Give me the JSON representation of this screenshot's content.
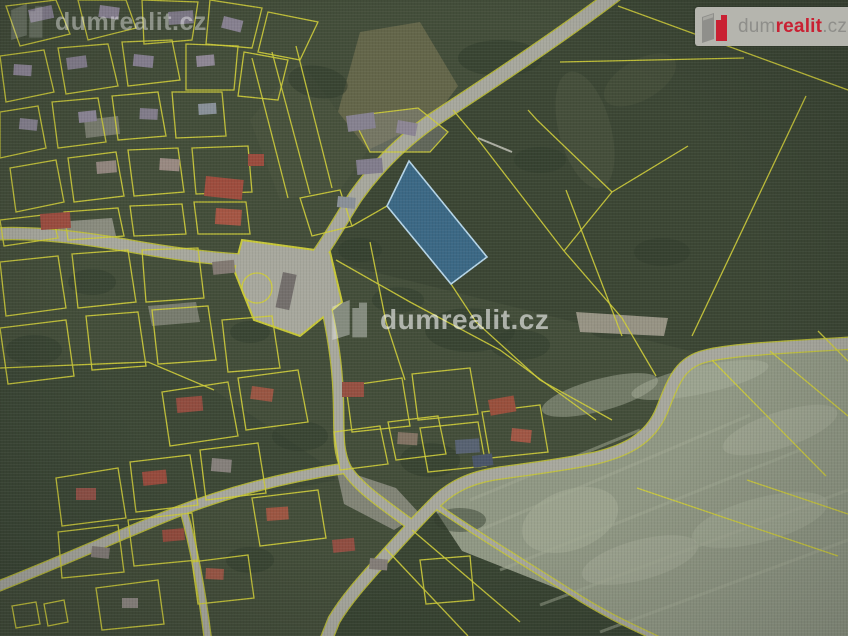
{
  "watermarks": {
    "top_left": "dumrealit.cz",
    "center": "dumrealit.cz"
  },
  "logo": {
    "part1": "dum",
    "part2": "realit",
    "part3": ".cz"
  },
  "map": {
    "base": "#47523c",
    "colors": {
      "parcel_line": "#dedc3c",
      "road_fill": "#b3b3a7",
      "road_edge": "#d6d63a",
      "veg": "#333f2d",
      "blotch": "#b8bfa8",
      "highlight_fill": "#3f8ed6",
      "highlight_stroke": "#c4e6fa"
    },
    "fields": [
      {
        "n": "field-right-dark",
        "p": "616,0 848,0 848,346 714,357 318,258 330,238 356,196 380,166 404,142 432,122 492,82 562,38",
        "f": "#3f4a36",
        "o": 1
      },
      {
        "n": "field-bottomright-light",
        "p": "432,505 470,480 524,471 572,463 616,452 650,435 668,408 679,374 706,357 780,350 848,343 848,636 654,636 558,589 462,551",
        "f": "#9aa28c",
        "o": 1
      },
      {
        "n": "field-tan",
        "p": "338,112 360,32 420,22 458,86 434,118 368,150",
        "f": "#6e6f4f",
        "o": 0.9
      },
      {
        "n": "field-bottom-strips",
        "p": "330,622 432,507 462,551 558,589 652,636 326,636",
        "f": "#3c4834",
        "o": 1
      },
      {
        "n": "field-topcenter",
        "p": "300,60 338,112 368,150 340,190 280,200 250,120",
        "f": "#4d5840",
        "o": 0.8
      },
      {
        "n": "field-bottomleft-dark",
        "p": "0,366 148,362 214,390 330,468 336,480 176,512 0,588",
        "f": "#404c38",
        "o": 1
      }
    ],
    "ellipses": [
      {
        "n": "field-sheen",
        "c": [
          585,
          130,
          26,
          60
        ],
        "f": "#59644a",
        "o": 0.38,
        "r": -15
      },
      {
        "n": "field-sheen",
        "c": [
          640,
          80,
          40,
          20
        ],
        "f": "#59644a",
        "o": 0.3,
        "r": -30
      },
      {
        "n": "mow-blotch",
        "c": [
          600,
          395,
          60,
          16
        ],
        "f": "#b8bfa8",
        "o": 0.45,
        "r": -15
      },
      {
        "n": "mow-blotch",
        "c": [
          700,
          380,
          70,
          14
        ],
        "f": "#b8bfa8",
        "o": 0.45,
        "r": -12
      },
      {
        "n": "mow-blotch",
        "c": [
          780,
          430,
          60,
          18
        ],
        "f": "#b8bfa8",
        "o": 0.4,
        "r": -18
      },
      {
        "n": "mow-blotch",
        "c": [
          570,
          520,
          50,
          30
        ],
        "f": "#b8bfa8",
        "o": 0.42,
        "r": -20
      },
      {
        "n": "mow-blotch",
        "c": [
          640,
          560,
          60,
          20
        ],
        "f": "#b8bfa8",
        "o": 0.4,
        "r": -15
      },
      {
        "n": "mow-blotch",
        "c": [
          760,
          520,
          70,
          22
        ],
        "f": "#b8bfa8",
        "o": 0.38,
        "r": -15
      },
      {
        "n": "trees",
        "c": [
          318,
          82,
          30,
          16
        ],
        "f": "#333f2d",
        "o": 0.55,
        "r": 10
      },
      {
        "n": "trees",
        "c": [
          500,
          58,
          42,
          18
        ],
        "f": "#333f2d",
        "o": 0.55,
        "r": 0
      },
      {
        "n": "trees",
        "c": [
          540,
          160,
          26,
          13
        ],
        "f": "#333f2d",
        "o": 0.5,
        "r": 0
      },
      {
        "n": "trees",
        "c": [
          470,
          330,
          45,
          22
        ],
        "f": "#333f2d",
        "o": 0.55,
        "r": 0
      },
      {
        "n": "trees",
        "c": [
          520,
          345,
          30,
          15
        ],
        "f": "#333f2d",
        "o": 0.5,
        "r": 0
      },
      {
        "n": "trees",
        "c": [
          430,
          460,
          30,
          17
        ],
        "f": "#333f2d",
        "o": 0.55,
        "r": 0
      },
      {
        "n": "trees",
        "c": [
          300,
          436,
          28,
          15
        ],
        "f": "#333f2d",
        "o": 0.5,
        "r": 0
      },
      {
        "n": "trees",
        "c": [
          250,
          332,
          20,
          11
        ],
        "f": "#333f2d",
        "o": 0.5,
        "r": 0
      },
      {
        "n": "trees",
        "c": [
          92,
          282,
          24,
          13
        ],
        "f": "#333f2d",
        "o": 0.5,
        "r": 0
      },
      {
        "n": "trees",
        "c": [
          34,
          350,
          28,
          15
        ],
        "f": "#333f2d",
        "o": 0.5,
        "r": 0
      },
      {
        "n": "trees",
        "c": [
          612,
          330,
          22,
          9
        ],
        "f": "#333f2d",
        "o": 0.45,
        "r": 0
      },
      {
        "n": "trees",
        "c": [
          662,
          252,
          28,
          14
        ],
        "f": "#333f2d",
        "o": 0.45,
        "r": 0
      },
      {
        "n": "trees",
        "c": [
          250,
          560,
          24,
          13
        ],
        "f": "#333f2d",
        "o": 0.5,
        "r": 0
      },
      {
        "n": "trees",
        "c": [
          398,
          300,
          26,
          13
        ],
        "f": "#333f2d",
        "o": 0.5,
        "r": 0
      },
      {
        "n": "trees",
        "c": [
          360,
          250,
          22,
          12
        ],
        "f": "#333f2d",
        "o": 0.5,
        "r": 0
      },
      {
        "n": "trees",
        "c": [
          460,
          520,
          26,
          12
        ],
        "f": "#333f2d",
        "o": 0.45,
        "r": 0
      }
    ],
    "stripes": [
      [
        480,
        530,
        750,
        415
      ],
      [
        500,
        570,
        800,
        450
      ],
      [
        540,
        605,
        848,
        490
      ],
      [
        600,
        632,
        848,
        540
      ],
      [
        470,
        500,
        640,
        430
      ]
    ],
    "patches": [
      {
        "n": "courtyard",
        "p": "56,222 112,218 116,236 60,240",
        "f": "#a6a699",
        "o": 0.8
      },
      {
        "n": "courtyard",
        "p": "336,468 396,488 420,514 394,530 344,504",
        "f": "#a6a699",
        "o": 0.7
      },
      {
        "n": "sand-strip",
        "p": "576,312 668,318 664,336 580,332",
        "f": "#b3ab9b",
        "o": 0.85
      },
      {
        "n": "courtyard",
        "p": "84,120 118,116 120,134 86,138",
        "f": "#a6a699",
        "o": 0.6
      },
      {
        "n": "courtyard",
        "p": "148,306 196,302 200,322 152,326",
        "f": "#a6a699",
        "o": 0.6
      },
      {
        "n": "courtyard",
        "p": "352,116 418,108 448,132 430,152 370,152",
        "f": "#8f8f86",
        "o": 0.5
      }
    ],
    "roads": [
      {
        "n": "road-main-ne",
        "d": "M 616,-6 C 558,38 488,84 430,122 C 402,142 376,168 356,196 C 344,214 330,240 318,256",
        "w": 13
      },
      {
        "n": "road-west",
        "d": "M 318,256 C 282,266 208,260 130,246 C 74,236 28,232 -6,234",
        "w": 11
      },
      {
        "n": "road-south",
        "d": "M 316,258 C 324,298 336,342 338,390 C 340,426 336,448 346,468 C 358,488 386,506 410,524",
        "w": 9
      },
      {
        "n": "road-bottomleft",
        "d": "M -6,588 C 60,562 122,534 174,513 C 232,490 292,476 346,468",
        "w": 9
      },
      {
        "n": "road-bottom-curve",
        "d": "M 852,343 C 792,347 734,349 706,356 C 680,362 674,380 662,410 C 650,440 624,451 596,458 C 558,466 520,470 494,474 C 464,479 446,491 432,506 C 418,520 398,542 380,562 C 362,582 346,600 334,620 L 326,640",
        "w": 11
      },
      {
        "n": "road-branch-south",
        "d": "M 184,512 C 194,548 202,592 208,640",
        "w": 6
      },
      {
        "n": "road-field-track",
        "d": "M 436,506 C 470,530 520,560 570,592 C 610,618 640,630 660,640",
        "w": 4
      }
    ],
    "junction": "242,240 330,252 342,302 300,336 254,320 234,270",
    "parcels": [
      "6,6 56,0 70,34 20,46",
      "78,0 126,0 136,28 88,40",
      "142,0 198,2 192,40 144,44",
      "210,0 262,8 252,48 206,44",
      "268,12 318,22 300,60 258,52",
      "0,56 44,50 54,92 6,102",
      "58,48 108,44 118,86 66,94",
      "122,42 172,40 180,80 128,86",
      "186,44 238,46 234,90 186,90",
      "244,52 288,60 278,100 238,96",
      "0,112 38,106 46,148 0,158",
      "52,102 98,98 106,142 58,148",
      "112,96 158,92 166,136 118,140",
      "172,92 222,92 226,136 176,138",
      "10,168 56,160 64,202 16,212",
      "68,158 116,152 124,196 74,202",
      "128,150 178,148 184,192 134,196",
      "192,148 248,146 252,192 196,194",
      "0,220 52,214 58,238 4,246",
      "64,212 118,208 124,236 68,240",
      "130,206 182,204 186,234 134,236",
      "194,202 246,202 250,234 198,234",
      "0,262 58,256 66,308 6,316",
      "72,254 128,250 136,302 78,308",
      "142,250 198,248 204,298 146,302",
      "0,328 66,320 74,376 8,384",
      "86,316 138,312 146,366 92,370",
      "152,310 208,306 216,360 158,364",
      "222,320 272,316 280,368 228,372",
      "162,392 228,382 238,436 170,446",
      "238,378 298,370 308,422 246,430",
      "56,478 118,468 126,518 62,526",
      "130,462 190,455 198,505 136,512",
      "200,450 258,443 266,493 206,500",
      "252,498 318,490 326,538 260,546",
      "58,532 118,525 124,572 62,578",
      "128,520 192,513 198,560 134,566",
      "192,562 248,555 254,598 198,604",
      "12,606 36,602 40,624 16,628",
      "44,604 64,600 68,622 48,626",
      "96,588 158,580 164,624 102,630",
      "346,386 402,378 410,426 352,432",
      "412,374 470,368 478,414 418,420",
      "420,428 478,422 486,466 428,472",
      "482,412 540,405 548,452 490,458",
      "334,432 380,426 388,464 340,470",
      "388,422 438,416 446,454 396,460",
      "300,198 340,190 352,226 312,236",
      "352,116 418,108 448,132 430,152 370,152",
      "420,560 470,556 474,600 426,604"
    ],
    "circle_parcel": {
      "cx": 257,
      "cy": 288,
      "r": 15
    },
    "lines": [
      "252,58 288,198",
      "272,52 310,194",
      "296,46 332,188",
      "352,226 387,206",
      "451,284 476,322 540,380 612,420",
      "370,242 386,322 405,380",
      "336,260 410,302 500,350 596,420",
      "453,110 480,142 564,251",
      "528,110 537,120 612,192",
      "612,192 564,251",
      "612,192 688,146",
      "564,251 622,318 656,376",
      "618,6 848,90",
      "560,62 744,58",
      "566,190 622,336",
      "806,96 692,336",
      "712,360 826,476",
      "770,351 848,416",
      "637,488 838,556",
      "747,480 848,514",
      "0,368 148,362 214,390",
      "385,548 468,636",
      "412,530 520,622",
      "818,331 848,361"
    ],
    "buildings": [
      [
        28,
        10,
        24,
        13,
        -12,
        "#8e8897"
      ],
      [
        100,
        5,
        20,
        12,
        8,
        "#978fa0"
      ],
      [
        168,
        12,
        25,
        13,
        -4,
        "#8a8493"
      ],
      [
        224,
        16,
        20,
        12,
        14,
        "#938c9c"
      ],
      [
        14,
        64,
        18,
        11,
        4,
        "#968e9e"
      ],
      [
        66,
        58,
        20,
        12,
        -8,
        "#8d8695"
      ],
      [
        134,
        54,
        20,
        12,
        6,
        "#90899a"
      ],
      [
        196,
        56,
        18,
        11,
        -5,
        "#99919f"
      ],
      [
        20,
        118,
        18,
        11,
        6,
        "#8f8a98"
      ],
      [
        78,
        112,
        18,
        11,
        -6,
        "#968fa0"
      ],
      [
        140,
        108,
        18,
        11,
        3,
        "#8b8593"
      ],
      [
        198,
        104,
        18,
        11,
        -4,
        "#929aa2"
      ],
      [
        40,
        214,
        30,
        16,
        -4,
        "#a85243"
      ],
      [
        206,
        176,
        38,
        20,
        6,
        "#a85140"
      ],
      [
        216,
        208,
        26,
        16,
        4,
        "#b05b47"
      ],
      [
        248,
        154,
        16,
        12,
        0,
        "#a55040"
      ],
      [
        96,
        162,
        20,
        12,
        -5,
        "#9c8f86"
      ],
      [
        160,
        158,
        20,
        12,
        4,
        "#a39289"
      ],
      [
        283,
        272,
        14,
        36,
        12,
        "#7b7672"
      ],
      [
        212,
        262,
        22,
        13,
        -6,
        "#8b8179"
      ],
      [
        346,
        116,
        28,
        16,
        -8,
        "#8f8a99"
      ],
      [
        398,
        120,
        20,
        13,
        10,
        "#968e9d"
      ],
      [
        356,
        160,
        26,
        15,
        -5,
        "#8a8595"
      ],
      [
        338,
        196,
        18,
        11,
        6,
        "#939aa1"
      ],
      [
        342,
        382,
        22,
        15,
        0,
        "#a05545"
      ],
      [
        488,
        400,
        26,
        16,
        -10,
        "#a3543f"
      ],
      [
        512,
        428,
        20,
        13,
        6,
        "#ab5c48"
      ],
      [
        455,
        440,
        24,
        14,
        -4,
        "#5d6878"
      ],
      [
        472,
        456,
        20,
        12,
        -8,
        "#4e5a6e"
      ],
      [
        176,
        398,
        26,
        15,
        -5,
        "#9b5142"
      ],
      [
        252,
        386,
        22,
        13,
        8,
        "#a35b46"
      ],
      [
        76,
        488,
        20,
        12,
        0,
        "#99564a"
      ],
      [
        142,
        472,
        24,
        14,
        -6,
        "#a25040"
      ],
      [
        212,
        458,
        20,
        13,
        5,
        "#8e8882"
      ],
      [
        266,
        508,
        22,
        13,
        -4,
        "#a75b45"
      ],
      [
        92,
        546,
        18,
        11,
        6,
        "#8b837d"
      ],
      [
        162,
        530,
        22,
        12,
        -5,
        "#9d5040"
      ],
      [
        206,
        568,
        18,
        11,
        3,
        "#a55c49"
      ],
      [
        122,
        598,
        16,
        10,
        0,
        "#968f88"
      ],
      [
        332,
        540,
        22,
        13,
        -6,
        "#9a5244"
      ],
      [
        370,
        558,
        18,
        11,
        5,
        "#8d867f"
      ],
      [
        398,
        432,
        20,
        12,
        4,
        "#8a7a68"
      ]
    ],
    "white_track": [
      478,
      138,
      512,
      152
    ],
    "highlight": {
      "points": "409,161 487,257 451,284 387,206",
      "fill_opacity": 0.55
    }
  }
}
